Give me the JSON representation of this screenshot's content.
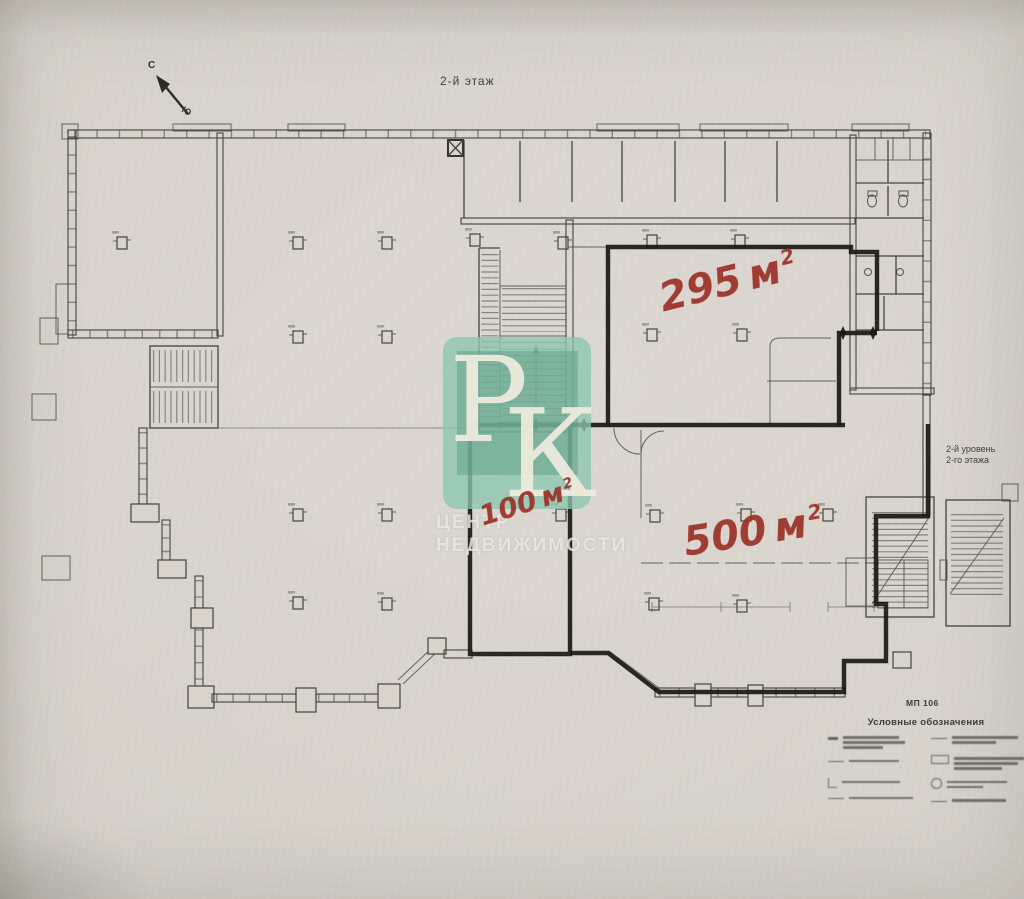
{
  "document": {
    "title": "2-й этаж",
    "paper_color": "#d8d4cc",
    "ink_color": "#46433b",
    "marker_color": "#191812"
  },
  "compass": {
    "north_label": "С",
    "south_label": "Ю"
  },
  "area_labels": {
    "color": "#9c342c",
    "a295": {
      "value": "295",
      "unit": "м",
      "sup": "2"
    },
    "a100": {
      "value": "100",
      "unit": "м",
      "sup": "2"
    },
    "a500": {
      "value": "500",
      "unit": "м",
      "sup": "2"
    }
  },
  "side_note": {
    "line1": "2-й уровень",
    "line2": "2-го этажа"
  },
  "legend": {
    "code": "МП 106",
    "title": "Условные обозначения"
  },
  "watermark": {
    "letter_top": "Р",
    "letter_bottom": "К",
    "caption_line1": "ЦЕНТР",
    "caption_line2": "НЕДВИЖИМОСТИ",
    "tile_color": "#8cc6ae"
  }
}
